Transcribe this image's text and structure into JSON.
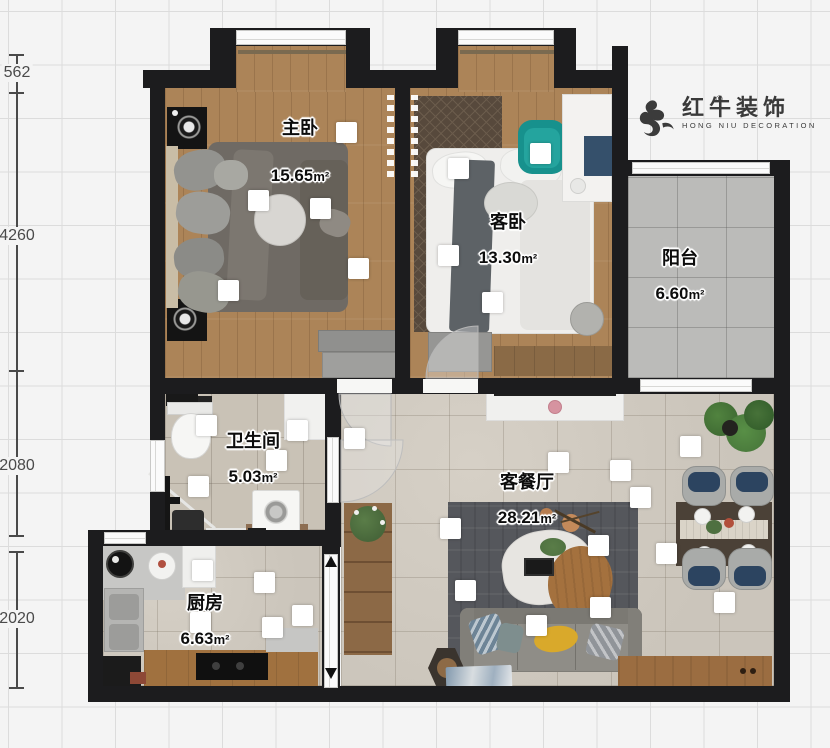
{
  "branding": {
    "name_cn": "红牛装饰",
    "name_en": "HONG NIU DECORATION",
    "registered": "®",
    "icon": "bull-icon",
    "color": "#3a3a3a"
  },
  "dims": [
    {
      "label": "562"
    },
    {
      "label": "4260"
    },
    {
      "label": "2080"
    },
    {
      "label": "2020"
    }
  ],
  "rooms": [
    {
      "id": "master-bedroom",
      "name": "主卧",
      "area": "15.65",
      "unit": "m²"
    },
    {
      "id": "guest-bedroom",
      "name": "客卧",
      "area": "13.30",
      "unit": "m²"
    },
    {
      "id": "balcony",
      "name": "阳台",
      "area": "6.60",
      "unit": "m²"
    },
    {
      "id": "bathroom",
      "name": "卫生间",
      "area": "5.03",
      "unit": "m²"
    },
    {
      "id": "living-dining",
      "name": "客餐厅",
      "area": "28.21",
      "unit": "m²"
    },
    {
      "id": "kitchen",
      "name": "厨房",
      "area": "6.63",
      "unit": "m²"
    }
  ],
  "downlights": [
    [
      248,
      190
    ],
    [
      336,
      122
    ],
    [
      310,
      198
    ],
    [
      348,
      258
    ],
    [
      218,
      280
    ],
    [
      530,
      143
    ],
    [
      448,
      158
    ],
    [
      438,
      245
    ],
    [
      482,
      292
    ],
    [
      196,
      415
    ],
    [
      266,
      450
    ],
    [
      188,
      476
    ],
    [
      287,
      420
    ],
    [
      344,
      428
    ],
    [
      192,
      560
    ],
    [
      190,
      612
    ],
    [
      254,
      572
    ],
    [
      262,
      617
    ],
    [
      292,
      605
    ],
    [
      440,
      518
    ],
    [
      455,
      580
    ],
    [
      526,
      615
    ],
    [
      590,
      597
    ],
    [
      588,
      535
    ],
    [
      630,
      487
    ],
    [
      680,
      436
    ],
    [
      656,
      543
    ],
    [
      714,
      592
    ],
    [
      548,
      452
    ],
    [
      610,
      460
    ]
  ],
  "colors": {
    "wall": "#1c1c1e",
    "wood_floor": "#ac8458",
    "living_tile": "#cdc7bd",
    "bath_tile": "#c9c2b6",
    "balcony_tile": "#bbbbb9",
    "rug_dark": "#55575c",
    "accent_teal": "#17918d",
    "accent_navy": "#2c4460",
    "accent_yellow": "#d9a92b",
    "wood_furniture": "#9b6d41"
  }
}
